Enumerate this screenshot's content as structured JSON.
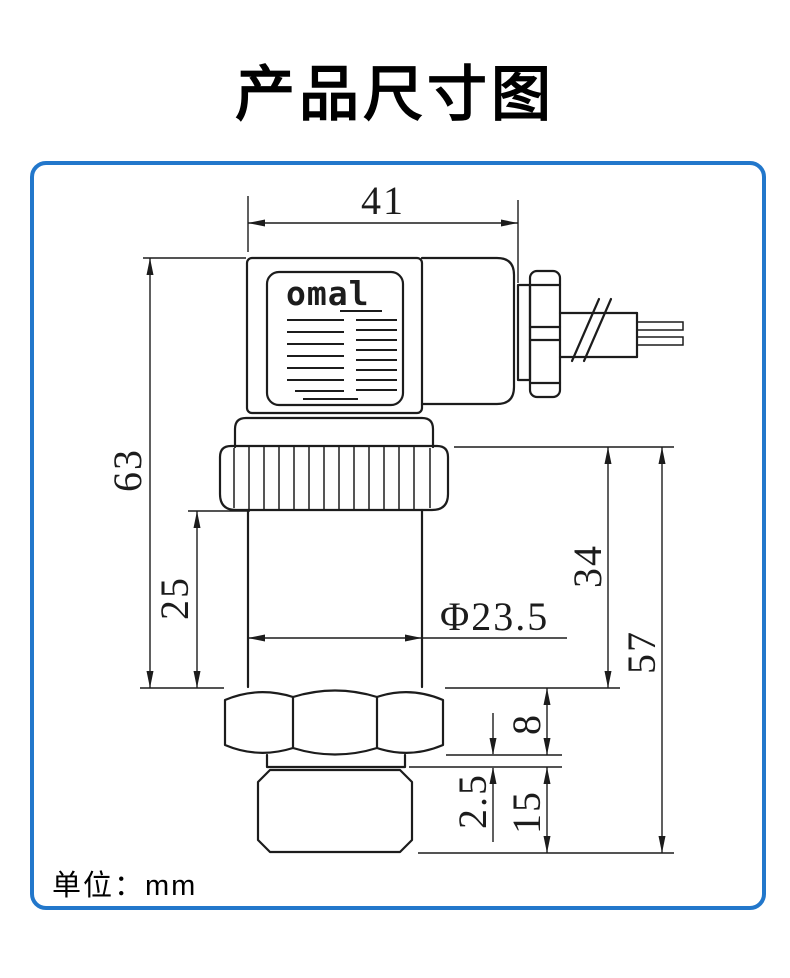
{
  "title": "产品尺寸图",
  "unit_label": "单位：mm",
  "colors": {
    "border": "#2277cb",
    "line": "#1c1c1c"
  },
  "device": {
    "logo": "omal"
  },
  "dimensions": {
    "connector_width": "41",
    "upper_overall_height": "63",
    "body_length": "25",
    "body_diameter": "Φ23.5",
    "lower_section_height": "34",
    "lower_total_height": "57",
    "hex_nut_height": "8",
    "washer_thickness": "2.5",
    "thread_length": "15"
  }
}
